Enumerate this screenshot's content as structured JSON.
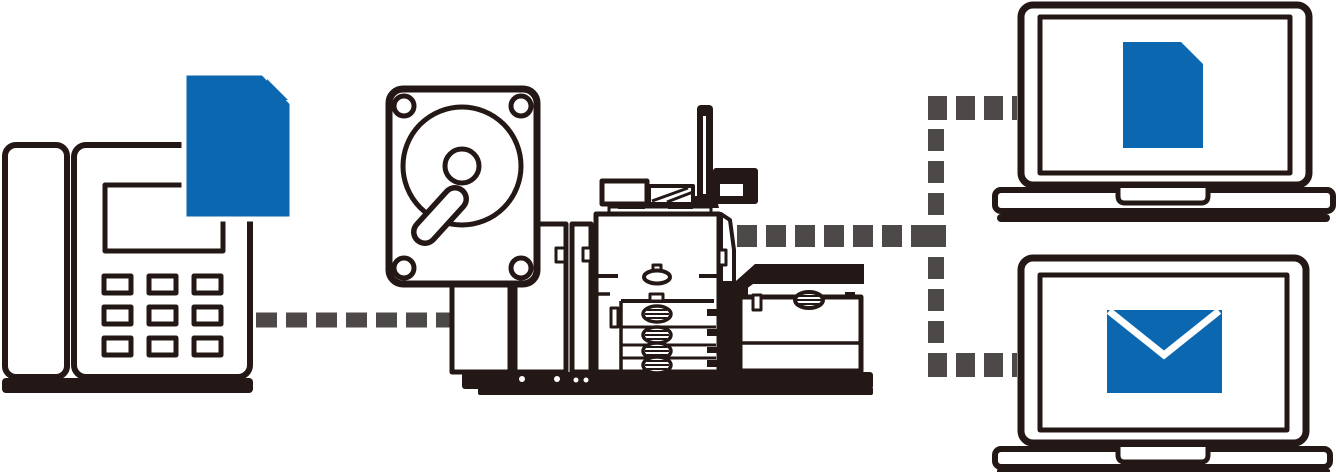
{
  "page": {
    "kind": "fax-to-digital-workflow-illustration",
    "background": "#ffffff"
  },
  "colors": {
    "outline_ink": "#231815",
    "icon_blue": "#0b68b0",
    "connector_gray": "#4c4948",
    "white": "#ffffff"
  },
  "nodes": [
    {
      "id": "fax-machine",
      "icon": "fax-phone-icon",
      "overlay_icon": "document-icon"
    },
    {
      "id": "hard-disk-drive",
      "icon": "hdd-icon"
    },
    {
      "id": "multifunction-printer",
      "icon": "production-printer-icon"
    },
    {
      "id": "laptop-document",
      "icon": "laptop-icon",
      "screen_icon": "document-icon"
    },
    {
      "id": "laptop-email",
      "icon": "laptop-icon",
      "screen_icon": "envelope-icon"
    }
  ],
  "connectors": [
    {
      "id": "fax-to-printer",
      "style": "dashed",
      "from": "fax-machine",
      "to": "multifunction-printer"
    },
    {
      "id": "printer-to-branch",
      "style": "dashed",
      "from": "multifunction-printer",
      "to": "branch"
    },
    {
      "id": "branch-vertical",
      "style": "dashed",
      "from": "branch",
      "to": "branch"
    },
    {
      "id": "branch-to-laptop-document",
      "style": "dashed",
      "from": "branch",
      "to": "laptop-document"
    },
    {
      "id": "branch-to-laptop-email",
      "style": "dashed",
      "from": "branch",
      "to": "laptop-email"
    }
  ]
}
